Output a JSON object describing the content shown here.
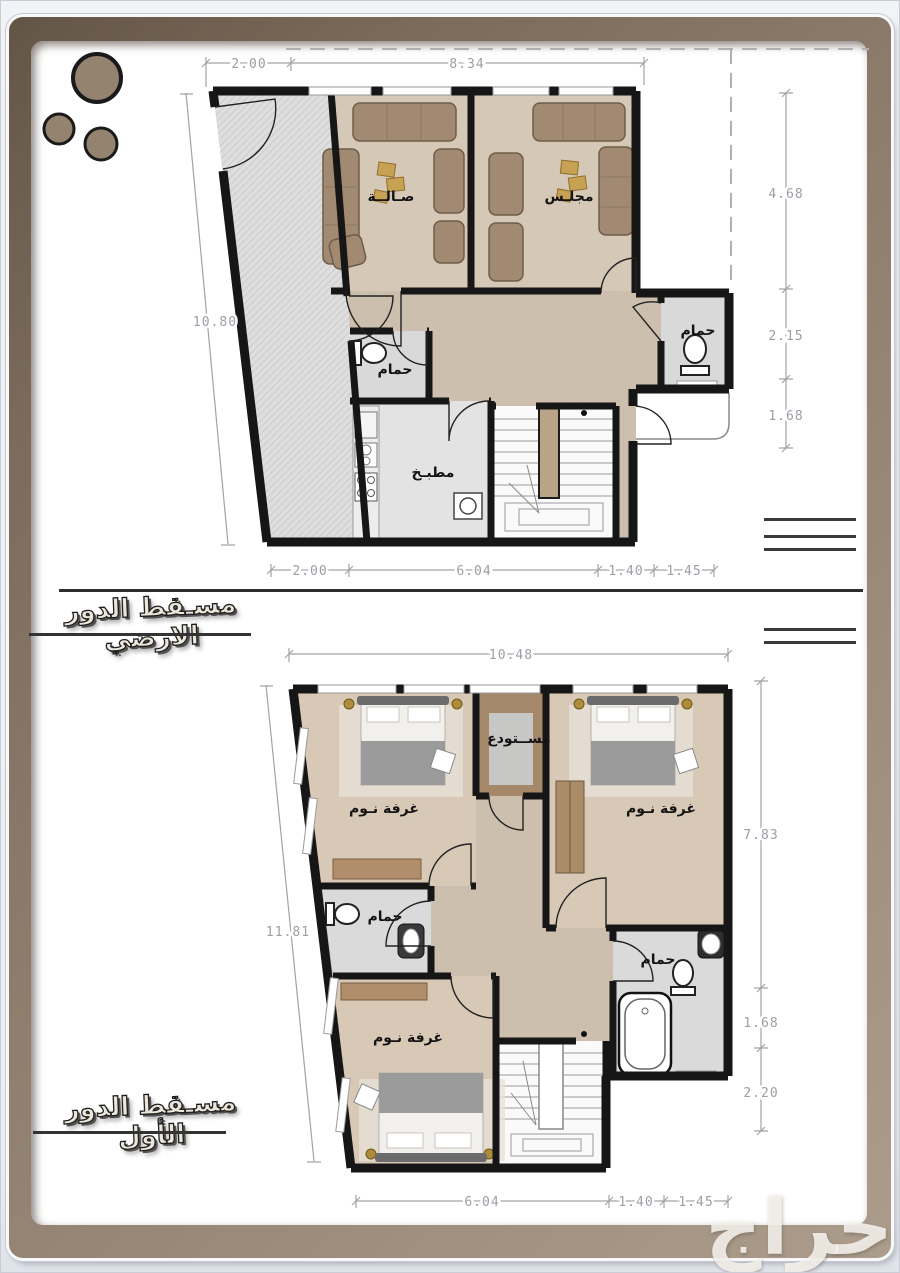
{
  "page": {
    "background": "#eef0f4",
    "frame_color": "#8f7e6d",
    "paper_color": "#ffffff"
  },
  "watermark": {
    "text": "حراج"
  },
  "floors": [
    {
      "title": "مسـقط الدور الارضي",
      "rooms": {
        "living": "صـالــة",
        "majlis": "مجلـس",
        "bath_left": "حمام",
        "bath_right": "حمام",
        "kitchen": "مطبـخ"
      },
      "dims": {
        "top": [
          "2.00",
          "8.34"
        ],
        "right": [
          "4.68",
          "2.15",
          "1.68"
        ],
        "left": [
          "10.80"
        ],
        "bottom": [
          "2.00",
          "6.04",
          "1.40",
          "1.45"
        ]
      }
    },
    {
      "title": "مسـقط الدور الأول",
      "rooms": {
        "bed_top_left": "غرفة نـوم",
        "store": "مســتودع",
        "bed_top_right": "غرفة نـوم",
        "bath_left": "حمام",
        "bath_right": "حمام",
        "bed_bottom": "غرفة نـوم"
      },
      "dims": {
        "top": [
          "10.48"
        ],
        "right": [
          "7.83",
          "1.68",
          "2.20"
        ],
        "left": [
          "11.81"
        ],
        "bottom": [
          "6.04",
          "1.40",
          "1.45"
        ]
      }
    }
  ]
}
